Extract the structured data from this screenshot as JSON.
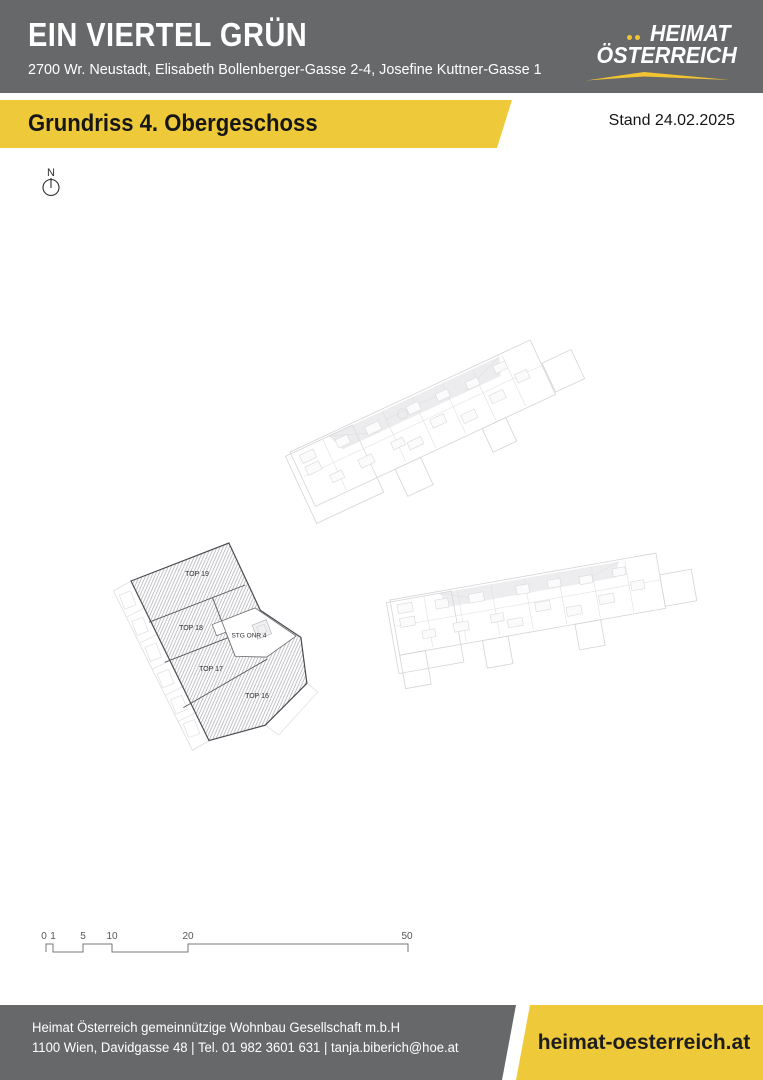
{
  "header": {
    "project_title": "EIN VIERTEL GRÜN",
    "project_address": "2700 Wr. Neustadt, Elisabeth Bollenberger-Gasse 2-4, Josefine Kuttner-Gasse 1"
  },
  "logo": {
    "line1": "HEIMAT",
    "line2": "ÖSTERREICH"
  },
  "banner": {
    "title": "Grundriss 4. Obergeschoss",
    "status_date": "Stand 24.02.2025"
  },
  "compass": {
    "north_label": "N"
  },
  "floorplan": {
    "unit_labels": [
      "TOP 19",
      "TOP 18",
      "TOP 17",
      "TOP 16"
    ],
    "staircase_label": "STG ONR 4"
  },
  "scale_bar": {
    "tick_labels": [
      "0",
      "1",
      "5",
      "10",
      "20",
      "50"
    ]
  },
  "footer": {
    "company_line": "Heimat Österreich gemeinnützige Wohnbau Gesellschaft m.b.H",
    "contact_line": "1100 Wien, Davidgasse 48 | Tel. 01 982 3601 631 | tanja.biberich@hoe.at",
    "website": "heimat-oesterreich.at"
  },
  "colors": {
    "brand_gray": "#67686a",
    "brand_yellow": "#eeca3a",
    "logo_accent": "#f2c431",
    "text_on_gray": "#ffffff",
    "text_on_yellow": "#1a1a1a"
  }
}
